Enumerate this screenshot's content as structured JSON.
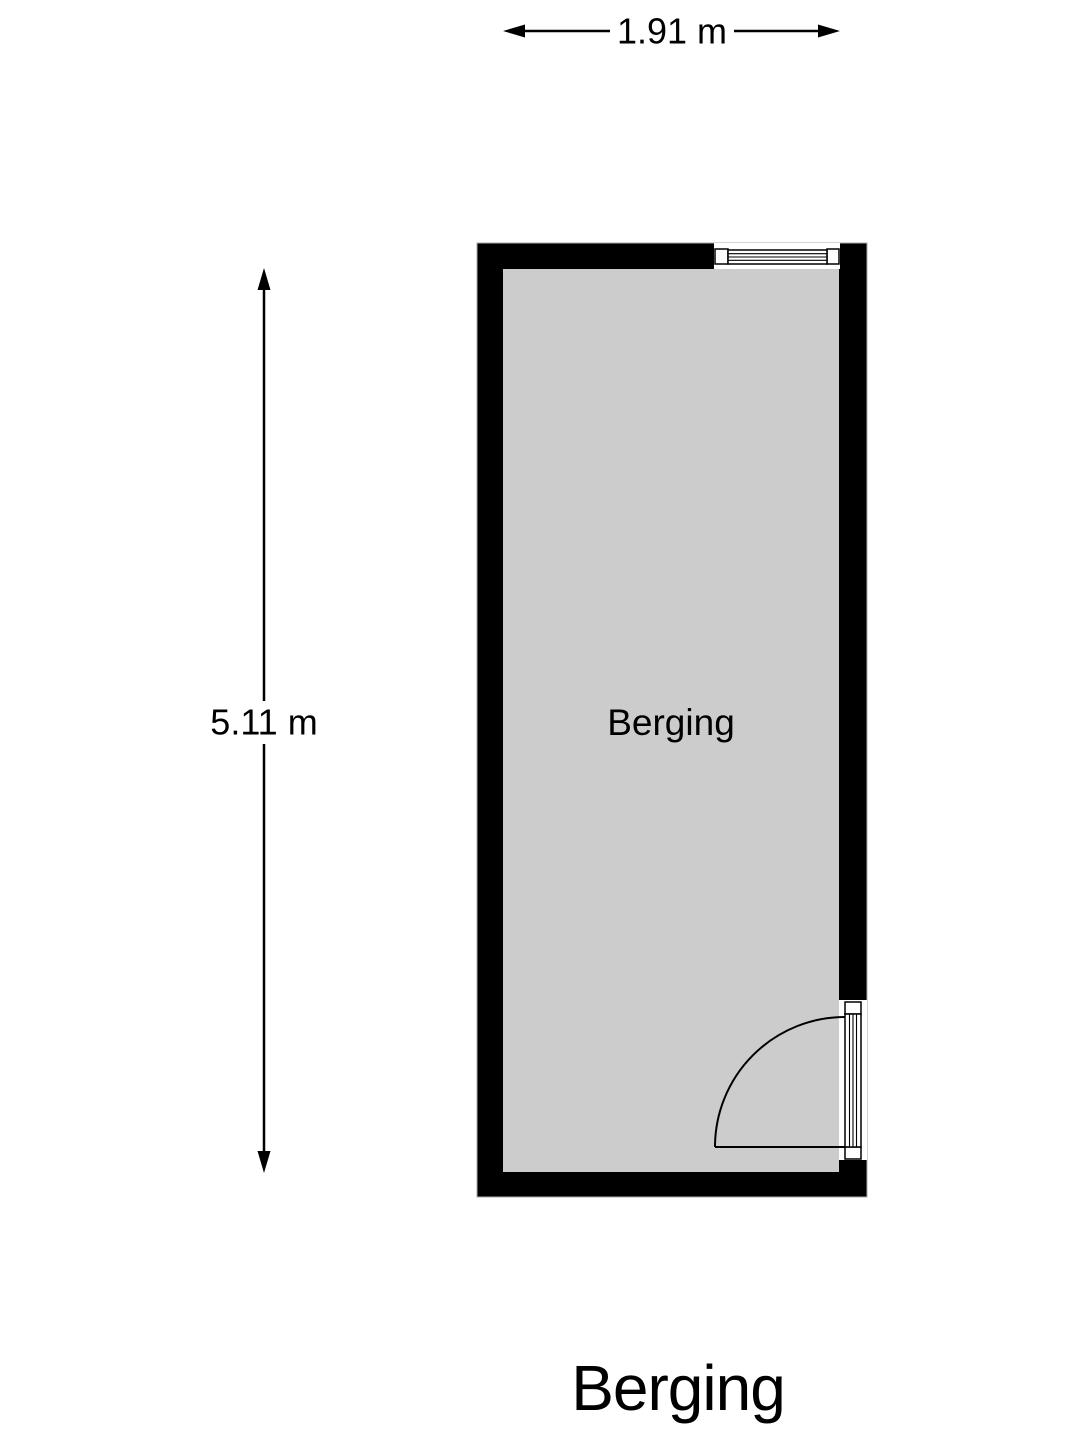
{
  "floor_plan": {
    "title": "Berging",
    "room": {
      "label": "Berging"
    },
    "dimensions": {
      "width_label": "1.91 m",
      "height_label": "5.11 m"
    },
    "features": {
      "window": "window-top-wall",
      "door": "glazed-door-right-wall-inward-swing"
    },
    "colors": {
      "wall": "#000000",
      "floor": "#cccccc",
      "background": "#ffffff",
      "line": "#000000",
      "wall_outline": "#a8a8a8"
    }
  }
}
